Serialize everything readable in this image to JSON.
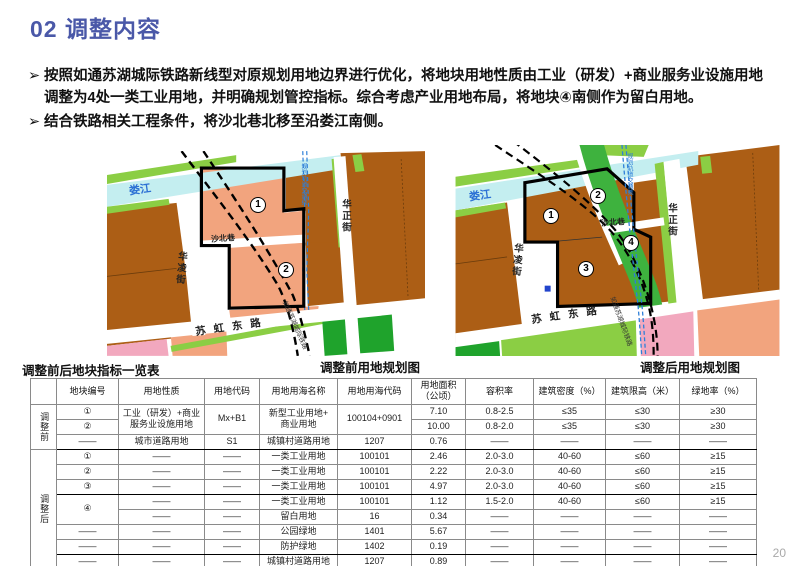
{
  "slide": {
    "title": "02 调整内容",
    "page_number": "20"
  },
  "bullets": {
    "marker": "➢",
    "items": [
      "按照如通苏湖城际铁路新线型对原规划用地边界进行优化，将地块用地性质由工业（研发）+商业服务业设施用地调整为4处一类工业用地，并明确规划管控指标。综合考虑产业用地布局，将地块④南侧作为留白用地。",
      "结合铁路相关工程条件，将沙北巷北移至沿娄江南侧。"
    ]
  },
  "maps": {
    "left": {
      "caption": "调整前用地规划图",
      "river_label": "娄江",
      "street_hualing": "华凌街",
      "street_huazheng": "华正街",
      "street_shabei": "沙北巷",
      "street_suhong": "苏虹东路",
      "railway_label": "如通苏湖城际铁路",
      "metro_label": "规划轨道交通线",
      "parcel_numbers": [
        "1",
        "2"
      ]
    },
    "right": {
      "caption": "调整后用地规划图",
      "river_label": "娄江",
      "street_hualing": "华凌街",
      "street_huazheng": "华正街",
      "street_shabei": "沙北巷",
      "street_suhong": "苏虹东路",
      "railway_label": "如通苏湖城际铁路",
      "metro_label": "规划轨道交通线",
      "parcel_numbers": [
        "1",
        "2",
        "3",
        "4"
      ]
    }
  },
  "colors": {
    "title_blue": "#4a58a8",
    "parcel_salmon": "#f2a47e",
    "parcel_brown": "#ac5e15",
    "river_cyan": "#c4eef0",
    "green_strip": "#8bce44",
    "green_corridor": "#3eb23e",
    "green_park": "#1fa32c",
    "parcel_pink": "#f2a8be",
    "metro_blue": "#2e7fd8"
  },
  "table": {
    "title": "调整前后地块指标一览表",
    "headers": [
      "",
      "地块编号",
      "用地性质",
      "用地代码",
      "用地用海名称",
      "用地用海代码",
      "用地面积（公顷）",
      "容积率",
      "建筑密度（%）",
      "建筑限高（米）",
      "绿地率（%）"
    ],
    "thick_after": [
      2,
      5,
      9
    ],
    "rows": [
      {
        "cells": [
          {
            "t": "调整前",
            "rs": 3,
            "cls": "group"
          },
          {
            "t": "①"
          },
          {
            "t": "工业（研发）+商业\n服务业设施用地",
            "rs": 2
          },
          {
            "t": "Mx+B1",
            "rs": 2
          },
          {
            "t": "新型工业用地+\n商业用地",
            "rs": 2
          },
          {
            "t": "100104+0901",
            "rs": 2
          },
          {
            "t": "7.10"
          },
          {
            "t": "0.8-2.5"
          },
          {
            "t": "≤35"
          },
          {
            "t": "≤30"
          },
          {
            "t": "≥30"
          }
        ]
      },
      {
        "cells": [
          {
            "t": "②"
          },
          {
            "t": "10.00"
          },
          {
            "t": "0.8-2.0"
          },
          {
            "t": "≤35"
          },
          {
            "t": "≤30"
          },
          {
            "t": "≥30"
          }
        ]
      },
      {
        "cells": [
          {
            "t": "——"
          },
          {
            "t": "城市道路用地"
          },
          {
            "t": "S1"
          },
          {
            "t": "城镇村道路用地"
          },
          {
            "t": "1207"
          },
          {
            "t": "0.76"
          },
          {
            "t": "——"
          },
          {
            "t": "——"
          },
          {
            "t": "——"
          },
          {
            "t": "——"
          }
        ]
      },
      {
        "cells": [
          {
            "t": "调整后",
            "rs": 8,
            "cls": "group"
          },
          {
            "t": "①"
          },
          {
            "t": "——"
          },
          {
            "t": "——"
          },
          {
            "t": "一类工业用地"
          },
          {
            "t": "100101"
          },
          {
            "t": "2.46"
          },
          {
            "t": "2.0-3.0"
          },
          {
            "t": "40-60"
          },
          {
            "t": "≤60"
          },
          {
            "t": "≥15"
          }
        ]
      },
      {
        "cells": [
          {
            "t": "②"
          },
          {
            "t": "——"
          },
          {
            "t": "——"
          },
          {
            "t": "一类工业用地"
          },
          {
            "t": "100101"
          },
          {
            "t": "2.22"
          },
          {
            "t": "2.0-3.0"
          },
          {
            "t": "40-60"
          },
          {
            "t": "≤60"
          },
          {
            "t": "≥15"
          }
        ]
      },
      {
        "cells": [
          {
            "t": "③"
          },
          {
            "t": "——"
          },
          {
            "t": "——"
          },
          {
            "t": "一类工业用地"
          },
          {
            "t": "100101"
          },
          {
            "t": "4.97"
          },
          {
            "t": "2.0-3.0"
          },
          {
            "t": "40-60"
          },
          {
            "t": "≤60"
          },
          {
            "t": "≥15"
          }
        ]
      },
      {
        "cells": [
          {
            "t": "④",
            "rs": 2
          },
          {
            "t": "——"
          },
          {
            "t": "——"
          },
          {
            "t": "一类工业用地"
          },
          {
            "t": "100101"
          },
          {
            "t": "1.12"
          },
          {
            "t": "1.5-2.0"
          },
          {
            "t": "40-60"
          },
          {
            "t": "≤60"
          },
          {
            "t": "≥15"
          }
        ]
      },
      {
        "cells": [
          {
            "t": "——"
          },
          {
            "t": "——"
          },
          {
            "t": "留白用地"
          },
          {
            "t": "16"
          },
          {
            "t": "0.34"
          },
          {
            "t": "——"
          },
          {
            "t": "——"
          },
          {
            "t": "——"
          },
          {
            "t": "——"
          }
        ]
      },
      {
        "cells": [
          {
            "t": "——"
          },
          {
            "t": "——"
          },
          {
            "t": "——"
          },
          {
            "t": "公园绿地"
          },
          {
            "t": "1401"
          },
          {
            "t": "5.67"
          },
          {
            "t": "——"
          },
          {
            "t": "——"
          },
          {
            "t": "——"
          },
          {
            "t": "——"
          }
        ]
      },
      {
        "cells": [
          {
            "t": "——"
          },
          {
            "t": "——"
          },
          {
            "t": "——"
          },
          {
            "t": "防护绿地"
          },
          {
            "t": "1402"
          },
          {
            "t": "0.19"
          },
          {
            "t": "——"
          },
          {
            "t": "——"
          },
          {
            "t": "——"
          },
          {
            "t": "——"
          }
        ]
      },
      {
        "cells": [
          {
            "t": "——"
          },
          {
            "t": "——"
          },
          {
            "t": "——"
          },
          {
            "t": "城镇村道路用地"
          },
          {
            "t": "1207"
          },
          {
            "t": "0.89"
          },
          {
            "t": "——"
          },
          {
            "t": "——"
          },
          {
            "t": "——"
          },
          {
            "t": "——"
          }
        ]
      }
    ]
  }
}
